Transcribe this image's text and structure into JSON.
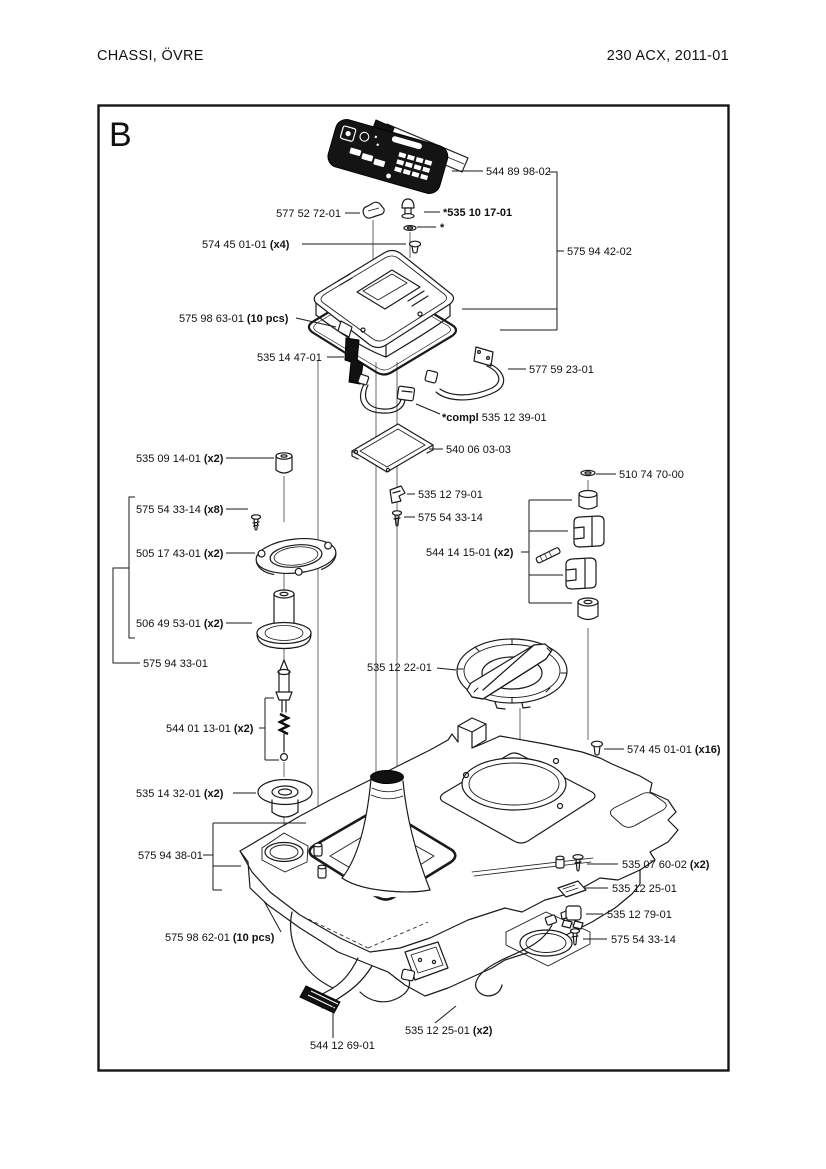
{
  "header": {
    "title_left": "CHASSI, ÖVRE",
    "title_right": "230 ACX, 2011-01"
  },
  "diagram": {
    "section_letter": "B",
    "parts": [
      {
        "name": "keypad-overlay",
        "label": "544 89 98-02"
      },
      {
        "name": "cover-assembly",
        "label": "575 94 42-02"
      },
      {
        "name": "cable-clip",
        "label": "577 52 72-01"
      },
      {
        "name": "pin",
        "label": "*535 10 17-01"
      },
      {
        "name": "washer-note",
        "label": "*"
      },
      {
        "name": "screw-torx",
        "label": "574 45 01-01",
        "qty": "(x4)"
      },
      {
        "name": "gasket-top",
        "label": "575 98 63-01",
        "qty": "(10 pcs)"
      },
      {
        "name": "rubber-strip",
        "label": "535 14 47-01"
      },
      {
        "name": "wire-handle",
        "label": "577 59 23-01"
      },
      {
        "name": "cable-complete",
        "label": "535 12 39-01",
        "prefix": "*compl "
      },
      {
        "name": "frame-plate",
        "label": "540 06 03-03"
      },
      {
        "name": "spacer-cylinder",
        "label": "535 09 14-01",
        "qty": "(x2)"
      },
      {
        "name": "screw-small",
        "label": "575 54 33-14",
        "qty": "(x8)"
      },
      {
        "name": "bearing-ring",
        "label": "505 17 43-01",
        "qty": "(x2)"
      },
      {
        "name": "height-spool",
        "label": "506 49 53-01",
        "qty": "(x2)"
      },
      {
        "name": "column-assembly",
        "label": "575 94 33-01"
      },
      {
        "name": "washer-top",
        "label": "510 74 70-00"
      },
      {
        "name": "clip-right",
        "label": "535 12 79-01"
      },
      {
        "name": "screw-right",
        "label": "575 54 33-14"
      },
      {
        "name": "contact-block-set",
        "label": "544 14 15-01",
        "qty": "(x2)"
      },
      {
        "name": "adjuster-cap",
        "label": "535 12 22-01"
      },
      {
        "name": "spring-pin",
        "label": "544 01 13-01",
        "qty": "(x2)"
      },
      {
        "name": "grommet",
        "label": "535 14 32-01",
        "qty": "(x2)"
      },
      {
        "name": "screw-chassis",
        "label": "574 45 01-01",
        "qty": "(x16)"
      },
      {
        "name": "screw-plate",
        "label": "535 07 60-02",
        "qty": "(x2)"
      },
      {
        "name": "contact-plate-right",
        "label": "535 12 25-01"
      },
      {
        "name": "clip-lower",
        "label": "535 12 79-01"
      },
      {
        "name": "screw-lower",
        "label": "575 54 33-14"
      },
      {
        "name": "chassis-assembly",
        "label": "575 94 38-01"
      },
      {
        "name": "gasket-bottom",
        "label": "575 98 62-01",
        "qty": "(10 pcs)"
      },
      {
        "name": "ribbon-cable",
        "label": "544 12 69-01"
      },
      {
        "name": "contact-plate-bottom",
        "label": "535 12 25-01",
        "qty": "(x2)"
      }
    ]
  }
}
